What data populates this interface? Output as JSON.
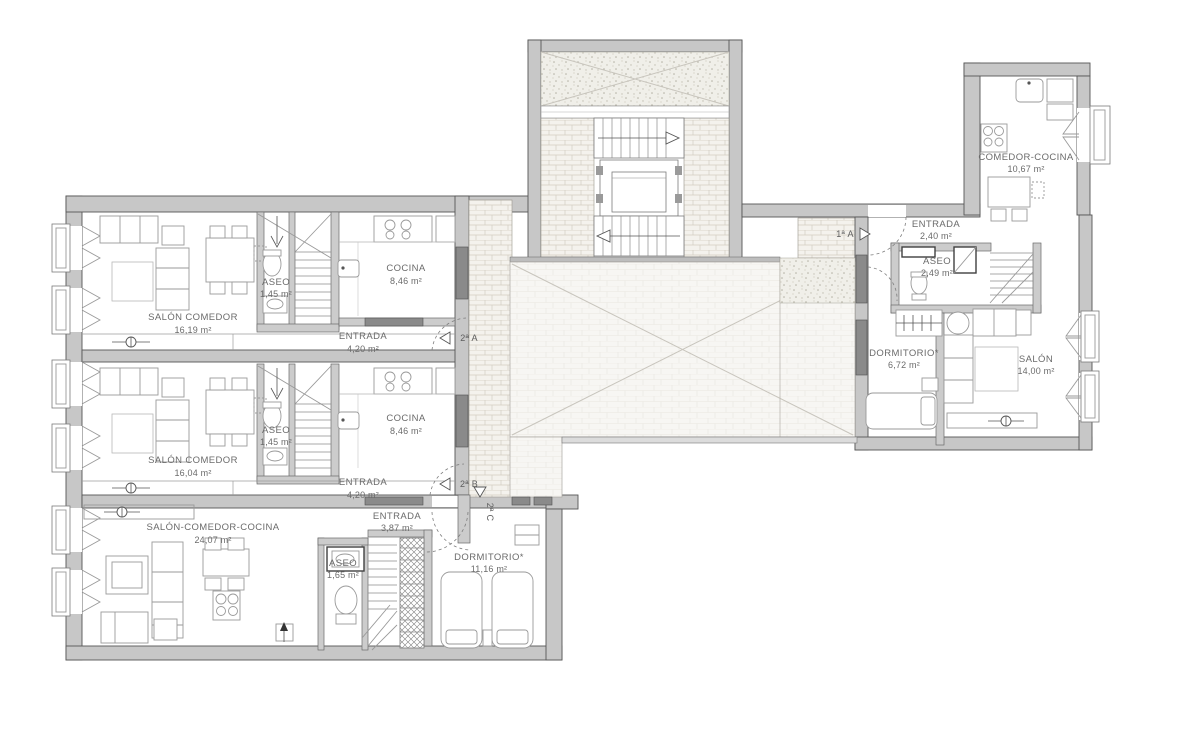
{
  "drawing": {
    "type": "floor-plan"
  },
  "colors": {
    "wall_fill": "#c7c7c7",
    "wall_line": "#565656",
    "text": "#6b6b6b",
    "brick": "#d3cec2",
    "stipple": "#b4b1a4",
    "patio_line": "#e8e5de"
  },
  "units": {
    "a2a": {
      "door_label": "2ª A",
      "rooms": {
        "salon": {
          "name": "SALÓN COMEDOR",
          "area": "16,19 m²"
        },
        "aseo": {
          "name": "ASEO",
          "area": "1,45 m²"
        },
        "cocina": {
          "name": "COCINA",
          "area": "8,46 m²"
        },
        "entrada": {
          "name": "ENTRADA",
          "area": "4,20 m²"
        }
      }
    },
    "a2b": {
      "door_label": "2ª B",
      "rooms": {
        "salon": {
          "name": "SALÓN COMEDOR",
          "area": "16,04 m²"
        },
        "aseo": {
          "name": "ASEO",
          "area": "1,45 m²"
        },
        "cocina": {
          "name": "COCINA",
          "area": "8,46 m²"
        },
        "entrada": {
          "name": "ENTRADA",
          "area": "4,20 m²"
        }
      }
    },
    "a2c": {
      "door_label": "2ª C",
      "rooms": {
        "salon": {
          "name": "SALÓN-COMEDOR-COCINA",
          "area": "24,07 m²"
        },
        "entrada": {
          "name": "ENTRADA",
          "area": "3,87 m²"
        },
        "aseo": {
          "name": "ASEO",
          "area": "1,65 m²"
        },
        "dormitorio": {
          "name": "DORMITORIO*",
          "area": "11,16 m²"
        }
      }
    },
    "a1a": {
      "door_label": "1ª A",
      "rooms": {
        "comedor": {
          "name": "COMEDOR-COCINA",
          "area": "10,67 m²"
        },
        "entrada": {
          "name": "ENTRADA",
          "area": "2,40 m²"
        },
        "aseo": {
          "name": "ASEO",
          "area": "2,49 m²"
        },
        "dormitorio": {
          "name": "DORMITORIO*",
          "area": "6,72 m²"
        },
        "salon": {
          "name": "SALÓN",
          "area": "14,00 m²"
        }
      }
    }
  }
}
